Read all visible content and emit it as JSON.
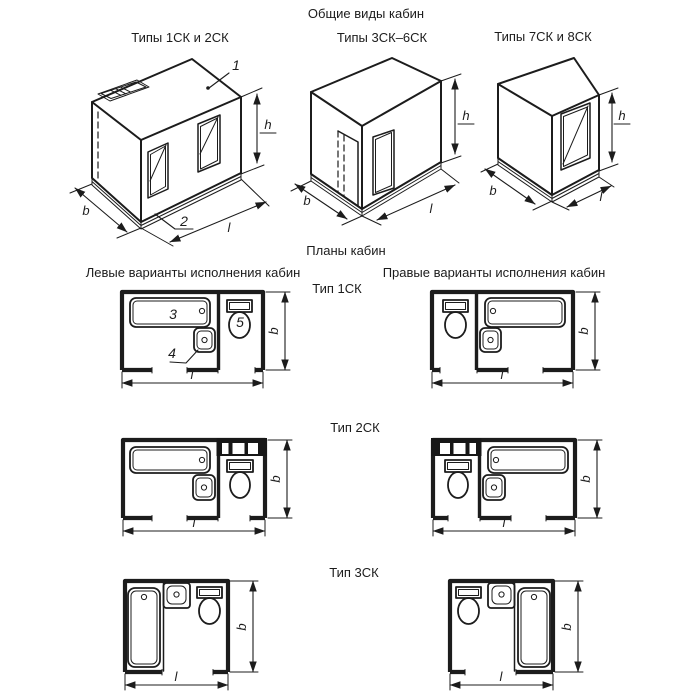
{
  "titles": {
    "general_views": "Общие виды кабин",
    "plans": "Планы кабин",
    "left_variants": "Левые варианты исполнения кабин",
    "right_variants": "Правые варианты исполнения кабин"
  },
  "view_titles": {
    "v1": "Типы 1СК и 2СК",
    "v2": "Типы 3СК–6СК",
    "v3": "Типы 7СК и 8СК"
  },
  "plan_titles": {
    "p1": "Тип 1СК",
    "p2": "Тип 2СК",
    "p3": "Тип 3СК"
  },
  "dim_labels": {
    "length": "l",
    "width": "b",
    "height": "h"
  },
  "callouts": {
    "c1": "1",
    "c2": "2",
    "c3": "3",
    "c4": "4",
    "c5": "5"
  },
  "colors": {
    "line": "#1c1c1c",
    "background": "#ffffff"
  }
}
